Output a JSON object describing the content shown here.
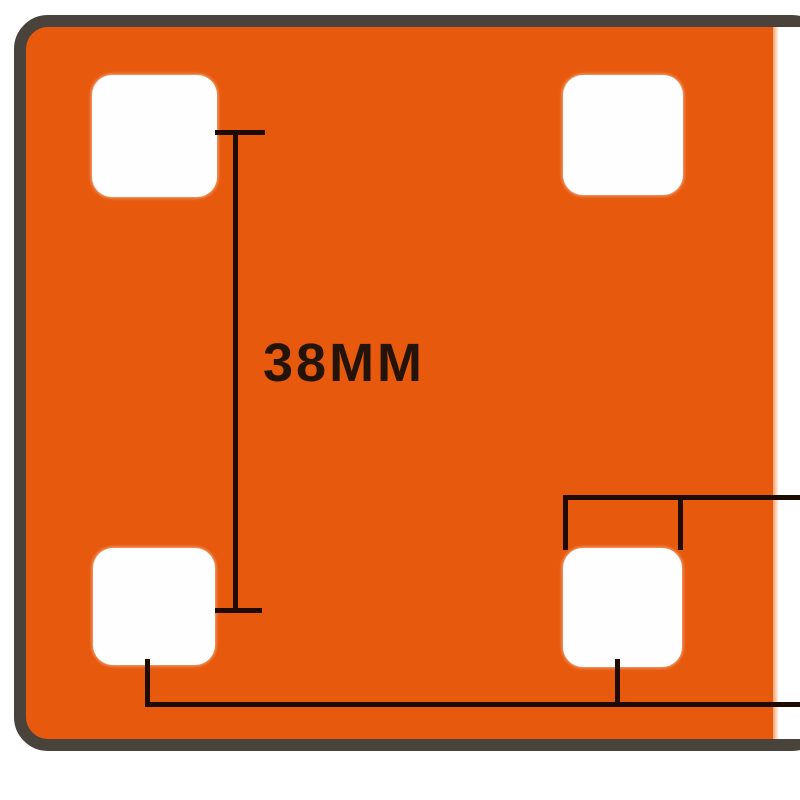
{
  "diagram": {
    "kind": "product dimension drawing",
    "subject": "orange mounting plate with four rounded square holes",
    "dimension_label": "38MM",
    "annotations": [
      {
        "id": "left-holes-vertical-spacing",
        "label": "38MM",
        "orientation": "vertical"
      },
      {
        "id": "bottom-right-hole-width",
        "label": "",
        "orientation": "horizontal"
      },
      {
        "id": "bottom-holes-horizontal-spacing",
        "label": "",
        "orientation": "horizontal"
      }
    ]
  },
  "colors": {
    "background": "#ffffff",
    "plate_fill": "#e7590d",
    "plate_border": "#4a433c",
    "hole_fill": "#fefefe",
    "dimension_line": "#1e0b01",
    "label_text": "#241307"
  }
}
